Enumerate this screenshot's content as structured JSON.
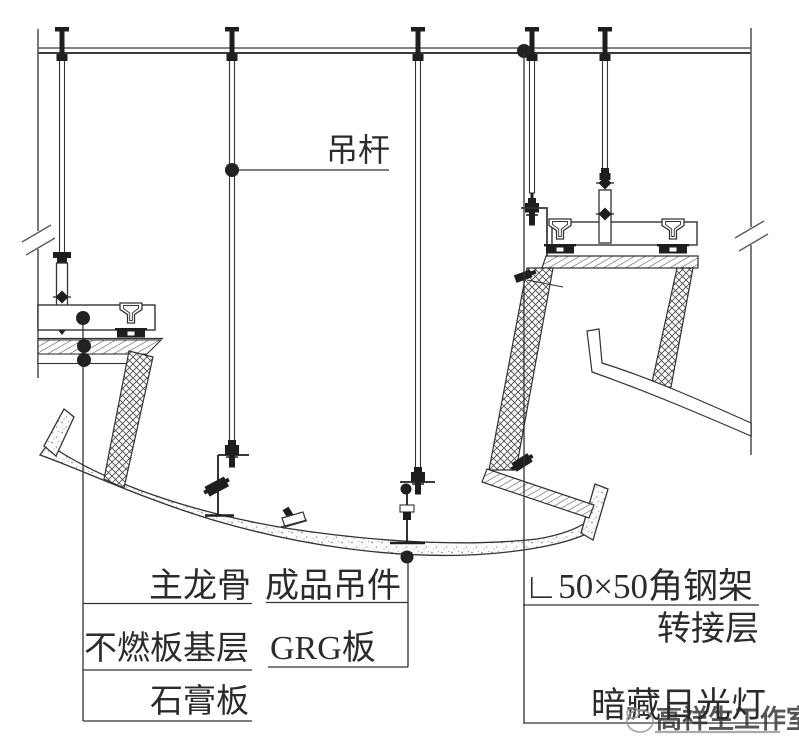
{
  "diagram": {
    "labels": {
      "hanger_rod": "吊杆",
      "main_runner": "主龙骨",
      "finished_hanger": "成品吊件",
      "fireproof_board_base": "不燃板基层",
      "grg_panel": "GRG板",
      "gypsum_board": "石膏板",
      "angle_steel_frame": "∟50×50角钢架",
      "adapter_layer": "转接层",
      "concealed_fluorescent_light": "暗藏日光灯"
    },
    "watermark": {
      "text": "高祥生工作室"
    },
    "colors": {
      "line": "#333333",
      "solid_black": "#1e1e1e",
      "hatch": "#555555",
      "stipple_dot": "#8d8d8d",
      "watermark": "#96969b",
      "background": "#ffffff"
    }
  }
}
